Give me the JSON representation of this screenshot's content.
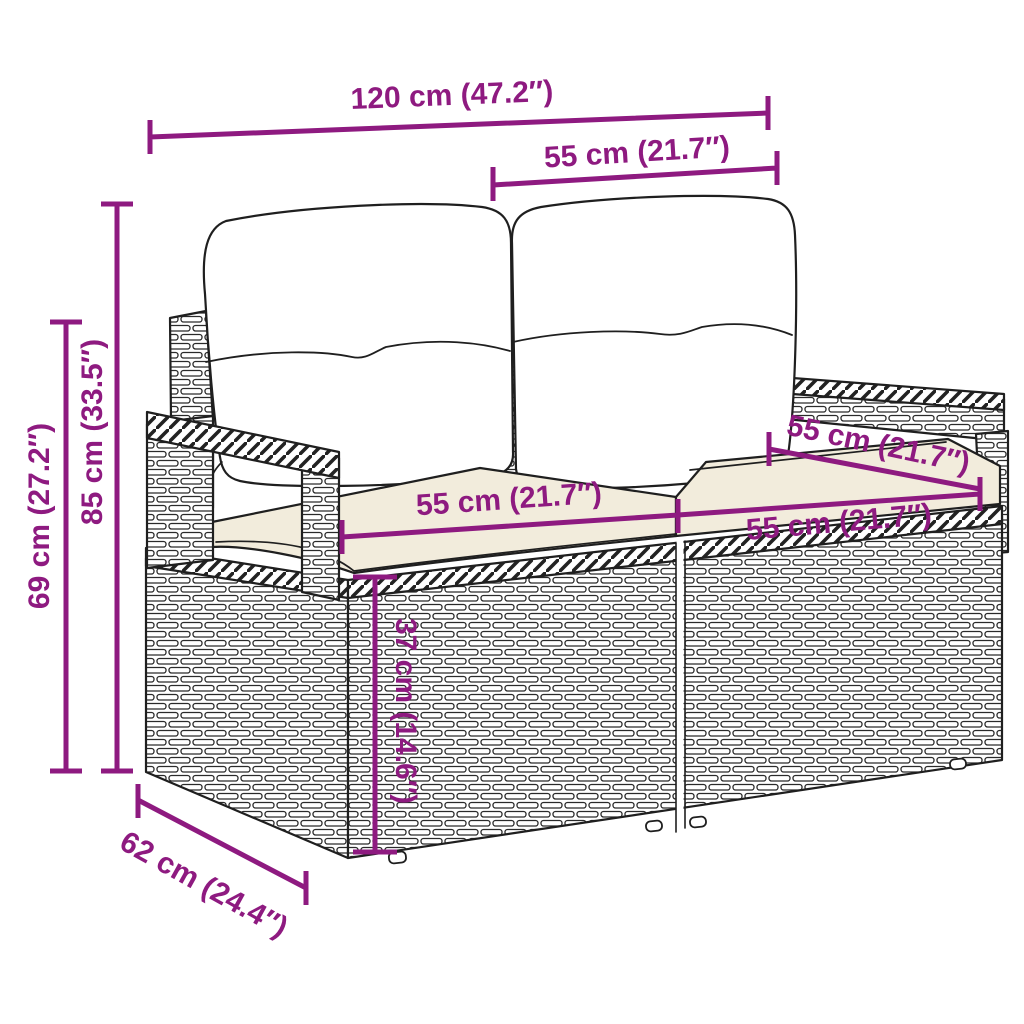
{
  "figure": {
    "alt": "Black-and-white line drawing of a 2-seater poly rattan garden sofa with two back cushions and two seat cushions, annotated with dimensions",
    "colors": {
      "accent": "#8E1A80",
      "outline": "#1F1F1F",
      "cushion_shade": "#F2ECDC",
      "background": "#FFFFFF"
    }
  },
  "dims": [
    {
      "id": "total-width",
      "text": "120 cm (47.2″)"
    },
    {
      "id": "back-section-width",
      "text": "55 cm (21.7″)"
    },
    {
      "id": "total-height",
      "text": "85 cm (33.5″)"
    },
    {
      "id": "armrest-height",
      "text": "69 cm (27.2″)"
    },
    {
      "id": "seat-width-left",
      "text": "55 cm (21.7″)"
    },
    {
      "id": "seat-width-right",
      "text": "55 cm (21.7″)"
    },
    {
      "id": "seat-depth",
      "text": "55 cm (21.7″)"
    },
    {
      "id": "seat-height",
      "text": "37 cm (14.6″)"
    },
    {
      "id": "total-depth",
      "text": "62 cm (24.4″)"
    }
  ]
}
